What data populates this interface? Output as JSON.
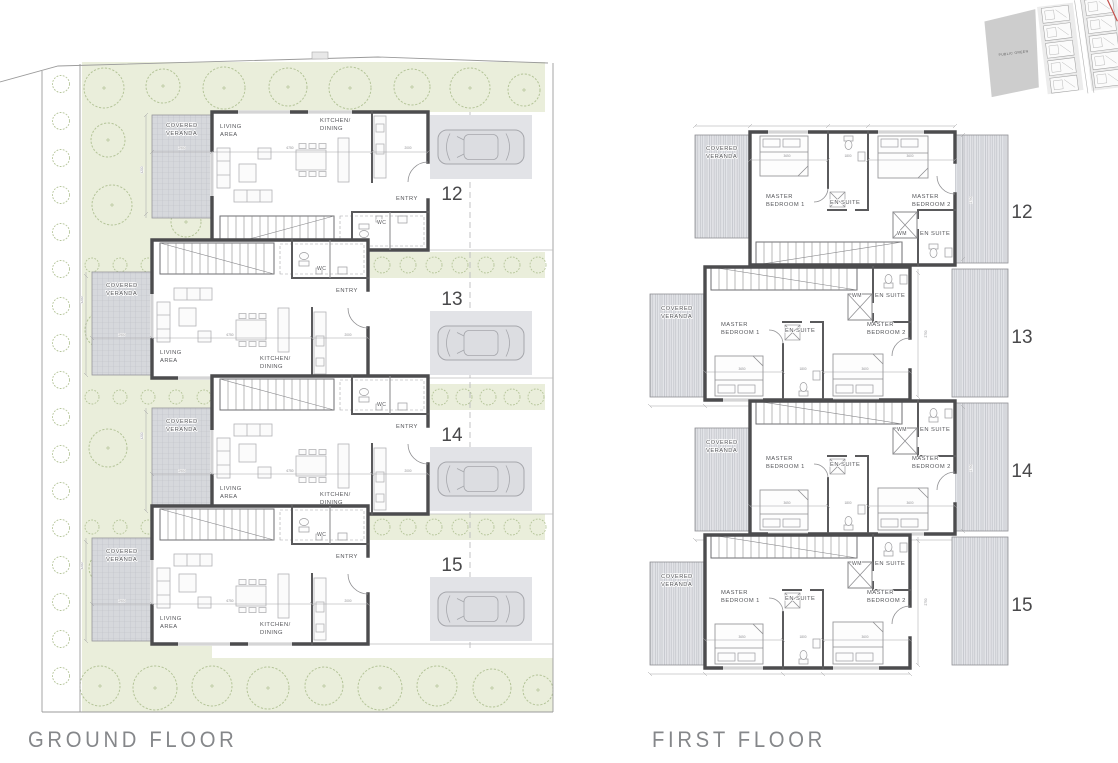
{
  "titles": {
    "ground": "GROUND FLOOR",
    "first": "FIRST FLOOR"
  },
  "site_map": {
    "area_label": "PUBLIC GREEN"
  },
  "ground_floor": {
    "units": [
      {
        "number": "12",
        "veranda": [
          "COVERED",
          "VERANDA"
        ],
        "living": [
          "LIVING",
          "AREA"
        ],
        "kitchen": [
          "KITCHEN/",
          "DINING"
        ],
        "entry": "ENTRY",
        "wc": "WC"
      },
      {
        "number": "13",
        "veranda": [
          "COVERED",
          "VERANDA"
        ],
        "living": [
          "LIVING",
          "AREA"
        ],
        "kitchen": [
          "KITCHEN/",
          "DINING"
        ],
        "entry": "ENTRY",
        "wc": "WC"
      },
      {
        "number": "14",
        "veranda": [
          "COVERED",
          "VERANDA"
        ],
        "living": [
          "LIVING",
          "AREA"
        ],
        "kitchen": [
          "KITCHEN/",
          "DINING"
        ],
        "entry": "ENTRY",
        "wc": "WC"
      },
      {
        "number": "15",
        "veranda": [
          "COVERED",
          "VERANDA"
        ],
        "living": [
          "LIVING",
          "AREA"
        ],
        "kitchen": [
          "KITCHEN/",
          "DINING"
        ],
        "entry": "ENTRY",
        "wc": "WC"
      }
    ],
    "dims": [
      "2900",
      "6750",
      "2000",
      "4200"
    ]
  },
  "first_floor": {
    "units": [
      {
        "number": "12",
        "veranda": [
          "COVERED",
          "VERANDA"
        ],
        "bedroom1": [
          "MASTER",
          "BEDROOM 1"
        ],
        "ensuite1": "EN SUITE",
        "bedroom2": [
          "MASTER",
          "BEDROOM 2"
        ],
        "ensuite2": "EN SUITE",
        "wm": "WM"
      },
      {
        "number": "13",
        "veranda": [
          "COVERED",
          "VERANDA"
        ],
        "bedroom1": [
          "MASTER",
          "BEDROOM 1"
        ],
        "ensuite1": "EN SUITE",
        "bedroom2": [
          "MASTER",
          "BEDROOM 2"
        ],
        "ensuite2": "EN SUITE",
        "wm": "WM"
      },
      {
        "number": "14",
        "veranda": [
          "COVERED",
          "VERANDA"
        ],
        "bedroom1": [
          "MASTER",
          "BEDROOM 1"
        ],
        "ensuite1": "EN SUITE",
        "bedroom2": [
          "MASTER",
          "BEDROOM 2"
        ],
        "ensuite2": "EN SUITE",
        "wm": "WM"
      },
      {
        "number": "15",
        "veranda": [
          "COVERED",
          "VERANDA"
        ],
        "bedroom1": [
          "MASTER",
          "BEDROOM 1"
        ],
        "ensuite1": "EN SUITE",
        "bedroom2": [
          "MASTER",
          "BEDROOM 2"
        ],
        "ensuite2": "EN SUITE",
        "wm": "WM"
      }
    ],
    "dims": [
      "3650",
      "1800",
      "3600",
      "2750"
    ]
  },
  "colors": {
    "landscape_green": "#eaeedb",
    "tree_outline": "#b4c498",
    "wall": "#4c4c4e",
    "veranda_hatch": "#d6d8dc",
    "car": "#dcdde1",
    "title_text": "#85878a",
    "unit_number_text": "#48484a",
    "map_area_gray": "#c8c8c8",
    "map_boundary_red": "#c34f4a"
  }
}
